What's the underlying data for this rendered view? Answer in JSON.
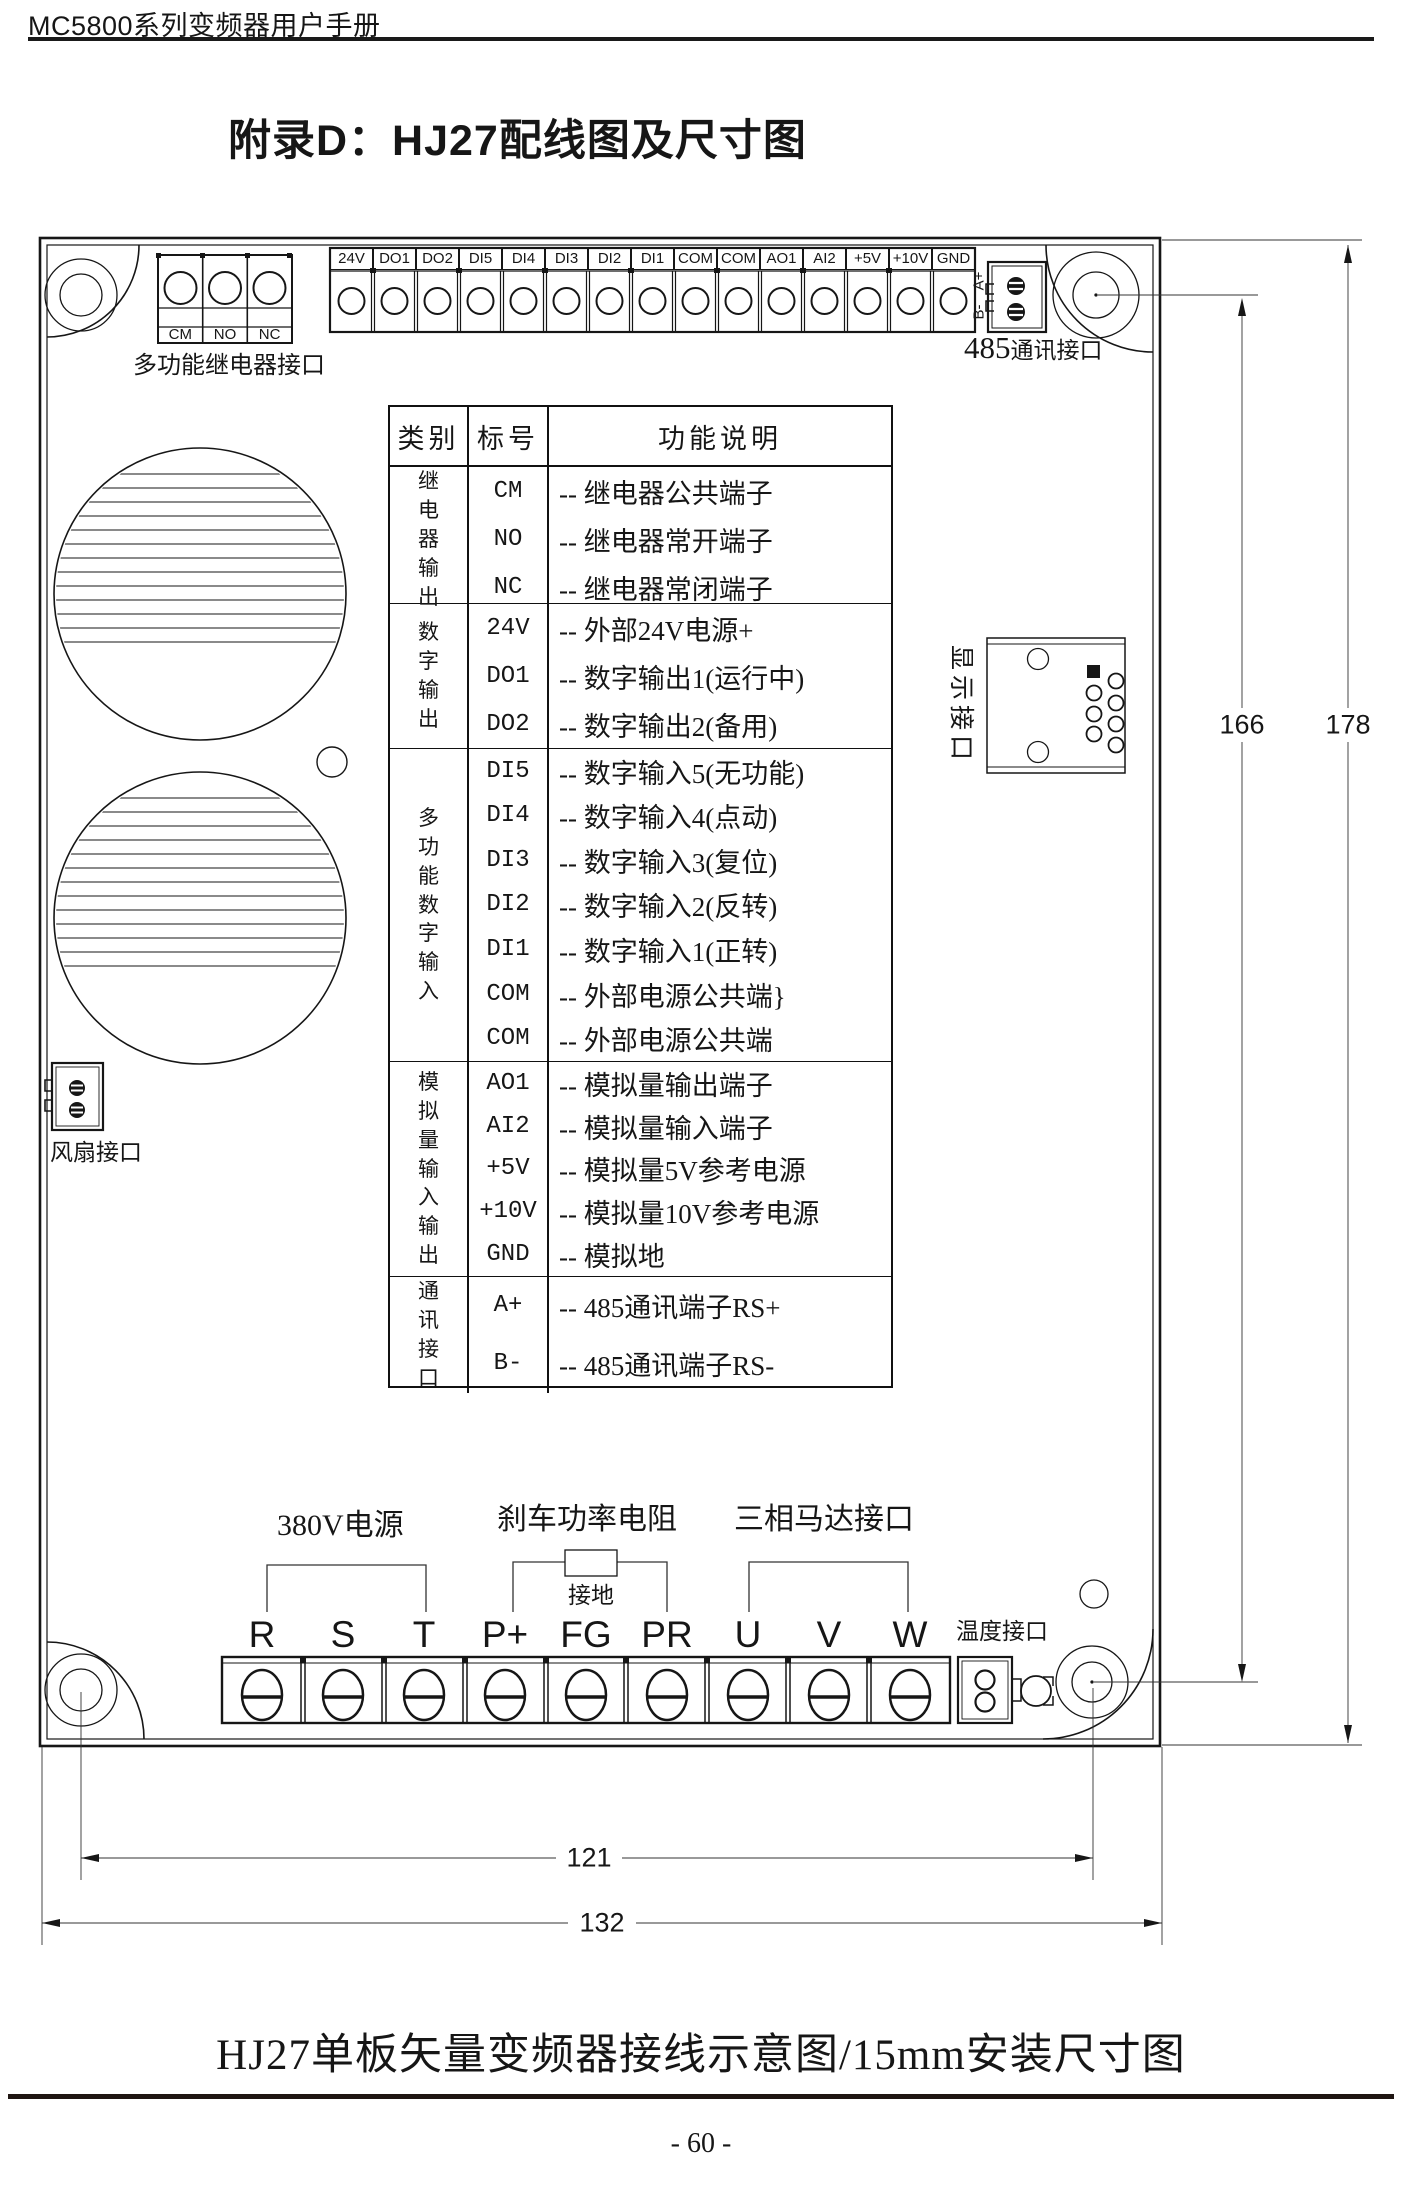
{
  "header": {
    "manual_title": "MC5800系列变频器用户手册"
  },
  "page_title": "附录D：HJ27配线图及尺寸图",
  "caption": "HJ27单板矢量变频器接线示意图/15mm安装尺寸图",
  "page_number": "- 60 -",
  "board": {
    "relay_connector": {
      "labels": [
        "CM",
        "NO",
        "NC"
      ],
      "caption": "多功能继电器接口"
    },
    "top_strip": {
      "labels": [
        "24V",
        "DO1",
        "DO2",
        "DI5",
        "DI4",
        "DI3",
        "DI2",
        "DI1",
        "COM",
        "COM",
        "AO1",
        "AI2",
        "+5V",
        "+10V",
        "GND"
      ]
    },
    "comm_485": {
      "pin_a": "A+",
      "pin_b": "B-",
      "number": "485",
      "text": "通讯接口"
    },
    "display_port": {
      "label": "显示接口"
    },
    "fan_port": {
      "label": "风扇接口"
    },
    "temp_port": {
      "label": "温度接口"
    },
    "bottom_strip": {
      "labels": [
        "R",
        "S",
        "T",
        "P+",
        "FG",
        "PR",
        "U",
        "V",
        "W"
      ]
    },
    "groups": {
      "power": "380V电源",
      "brake": "刹车功率电阻",
      "ground": "接地",
      "motor": "三相马达接口"
    },
    "dimensions": {
      "v_inner": "166",
      "v_outer": "178",
      "h_inner": "121",
      "h_outer": "132"
    }
  },
  "table": {
    "headers": [
      "类别",
      "标号",
      "功能说明"
    ],
    "sections": [
      {
        "category": "继电器输出",
        "rows": [
          {
            "label": "CM",
            "desc": "-- 继电器公共端子"
          },
          {
            "label": "NO",
            "desc": "-- 继电器常开端子"
          },
          {
            "label": "NC",
            "desc": "-- 继电器常闭端子"
          }
        ]
      },
      {
        "category": "数字输出",
        "rows": [
          {
            "label": "24V",
            "desc": "-- 外部24V电源+"
          },
          {
            "label": "DO1",
            "desc": "-- 数字输出1(运行中)"
          },
          {
            "label": "DO2",
            "desc": "-- 数字输出2(备用)"
          }
        ]
      },
      {
        "category": "多功能数字输入",
        "rows": [
          {
            "label": "DI5",
            "desc": "-- 数字输入5(无功能)"
          },
          {
            "label": "DI4",
            "desc": "-- 数字输入4(点动)"
          },
          {
            "label": "DI3",
            "desc": "-- 数字输入3(复位)"
          },
          {
            "label": "DI2",
            "desc": "-- 数字输入2(反转)"
          },
          {
            "label": "DI1",
            "desc": "-- 数字输入1(正转)"
          },
          {
            "label": "COM",
            "desc": "-- 外部电源公共端}"
          },
          {
            "label": "COM",
            "desc": "-- 外部电源公共端"
          }
        ]
      },
      {
        "category": "模拟量输入输出",
        "rows": [
          {
            "label": "AO1",
            "desc": "-- 模拟量输出端子"
          },
          {
            "label": "AI2",
            "desc": "-- 模拟量输入端子"
          },
          {
            "label": "+5V",
            "desc": "-- 模拟量5V参考电源"
          },
          {
            "label": "+10V",
            "desc": "-- 模拟量10V参考电源"
          },
          {
            "label": "GND",
            "desc": "-- 模拟地"
          }
        ]
      },
      {
        "category": "通讯接口",
        "rows": [
          {
            "label": "A+",
            "desc": "-- 485通讯端子RS+"
          },
          {
            "label": "B-",
            "desc": "-- 485通讯端子RS-"
          }
        ]
      }
    ]
  }
}
